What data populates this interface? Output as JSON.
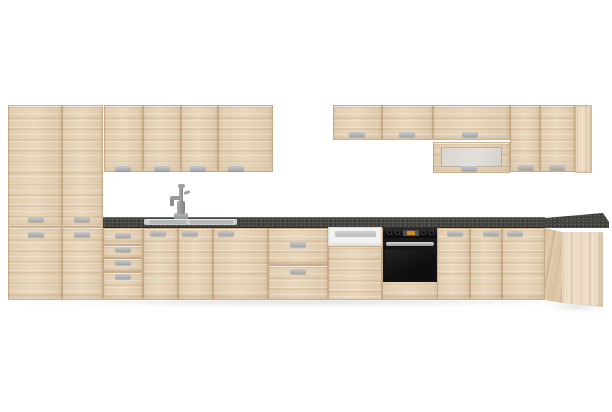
{
  "title": "Light oak kitchen cabinet set with dark worktop, sink, dishwasher and built-in oven",
  "scene": {
    "background": "#ffffff",
    "view": "straight-on product render, no text or UI controls visible"
  },
  "colors": {
    "bg": "#ffffff",
    "wood": "#e8d5b9",
    "wood-light": "#eddcc2",
    "wood-dark": "#dcc5a4",
    "seam": "rgba(160,122,78,0.40)",
    "handle-light": "#c6c9cb",
    "handle-dark": "#a2a6a8",
    "counter": "#45433f",
    "counter-edge": "#6e6c66",
    "oven-black": "#161616",
    "oven-handle": "#d8dadb",
    "oven-display": "#d98a1f",
    "dishwasher-white": "#f2f2f0",
    "dishwasher-groove": "#ccd0cd",
    "glass": "#d9d5cf",
    "sink": "#c9cdcc",
    "sink-basin": "#b4b9b8",
    "faucet": "#8f9391"
  },
  "components": [
    "tall-pantry-cabinet-left",
    "tall-pantry-cabinet-right",
    "wall-cabinet-run-left",
    "wall-cabinet-run-right",
    "frosted-glass-lift-up-wall-cabinet",
    "wall-end-panel",
    "dark-stone-worktop",
    "corner-worktop",
    "inset-sink",
    "tall-mixer-faucet",
    "four-drawer-base-unit",
    "sink-base-two-doors",
    "wide-base-door",
    "two-drawer-base-unit",
    "semi-integrated-dishwasher",
    "built-in-black-oven",
    "base-doors-right",
    "corner-base-cabinet",
    "floor-shadow"
  ]
}
